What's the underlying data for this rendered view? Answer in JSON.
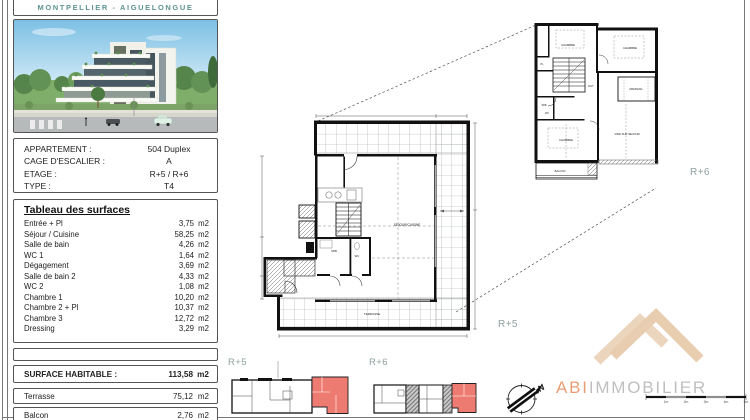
{
  "header": {
    "location": "MONTPELLIER - AIGUELONGUE"
  },
  "info": {
    "rows": [
      {
        "label": "APPARTEMENT :",
        "value": "504 Duplex"
      },
      {
        "label": "CAGE D'ESCALIER :",
        "value": "A"
      },
      {
        "label": "ETAGE :",
        "value": "R+5 / R+6"
      },
      {
        "label": "TYPE :",
        "value": "T4"
      }
    ]
  },
  "surfaces": {
    "title": "Tableau des surfaces",
    "rows": [
      {
        "label": "Entrée + Pl",
        "value": "3,75",
        "unit": "m2"
      },
      {
        "label": "Séjour / Cuisine",
        "value": "58,25",
        "unit": "m2"
      },
      {
        "label": "Salle de bain",
        "value": "4,26",
        "unit": "m2"
      },
      {
        "label": "WC 1",
        "value": "1,64",
        "unit": "m2"
      },
      {
        "label": "Dégagement",
        "value": "3,69",
        "unit": "m2"
      },
      {
        "label": "Salle de bain 2",
        "value": "4,33",
        "unit": "m2"
      },
      {
        "label": "WC 2",
        "value": "1,08",
        "unit": "m2"
      },
      {
        "label": "Chambre 1",
        "value": "10,20",
        "unit": "m2"
      },
      {
        "label": "Chambre 2 + Pl",
        "value": "10,37",
        "unit": "m2"
      },
      {
        "label": "Chambre 3",
        "value": "12,72",
        "unit": "m2"
      },
      {
        "label": "Dressing",
        "value": "3,29",
        "unit": "m2"
      }
    ],
    "habitable": {
      "label": "SURFACE HABITABLE :",
      "value": "113,58",
      "unit": "m2"
    },
    "terrasse": {
      "label": "Terrasse",
      "value": "75,12",
      "unit": "m2"
    },
    "balcon": {
      "label": "Balcon",
      "value": "2,76",
      "unit": "m2"
    }
  },
  "plans": {
    "main": {
      "floor": "R+5",
      "sejour": "SEJOUR/CUISINE",
      "terrasse": "TERRASSE",
      "sdb": "SDB",
      "wc": "WC"
    },
    "upper": {
      "floor": "R+6",
      "chambre_a": "CHAMBRE",
      "chambre_b": "CHAMBRE",
      "chambre_c": "CHAMBRE",
      "pl": "PL",
      "dgt": "DGT",
      "dressing": "DRESSING",
      "vide": "VIDE SUR SEJOUR",
      "sdb": "SDB",
      "wc": "WC",
      "balcon": "BALCON"
    },
    "key_r5": {
      "label": "R+5"
    },
    "key_r6": {
      "label": "R+6"
    }
  },
  "branding": {
    "accent": "ABI",
    "rest": "IMMOBILIER"
  },
  "compass": {
    "north": "N"
  },
  "scalebar": {
    "labels": [
      "1m",
      "2m",
      "3m",
      "4m",
      "5m"
    ]
  },
  "colors": {
    "accent_red": "#ee7b71",
    "teal_label": "#8fa0a0",
    "logo_beige": "#ecd5bd",
    "logo_accent": "#e89e74"
  }
}
